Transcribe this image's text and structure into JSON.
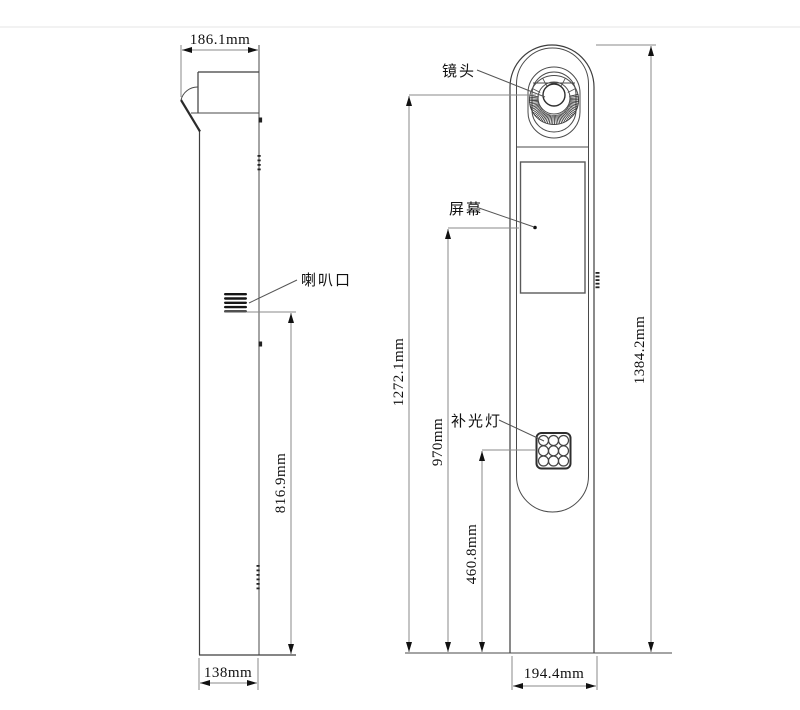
{
  "side": {
    "speaker_label": "喇叭口",
    "top_width": "186.1mm",
    "speaker_height": "816.9mm",
    "base_depth": "138mm"
  },
  "front": {
    "lens_label": "镜头",
    "screen_label": "屏幕",
    "fill_light_label": "补光灯",
    "lens_center_height": "1272.1mm",
    "screen_center_height": "970mm",
    "fill_light_center_height": "460.8mm",
    "total_height": "1384.2mm",
    "base_width": "194.4mm"
  },
  "colors": {
    "outline": "#3d3d3d",
    "dimension_line": "#8a8a8a",
    "text": "#111111",
    "background": "#ffffff"
  }
}
